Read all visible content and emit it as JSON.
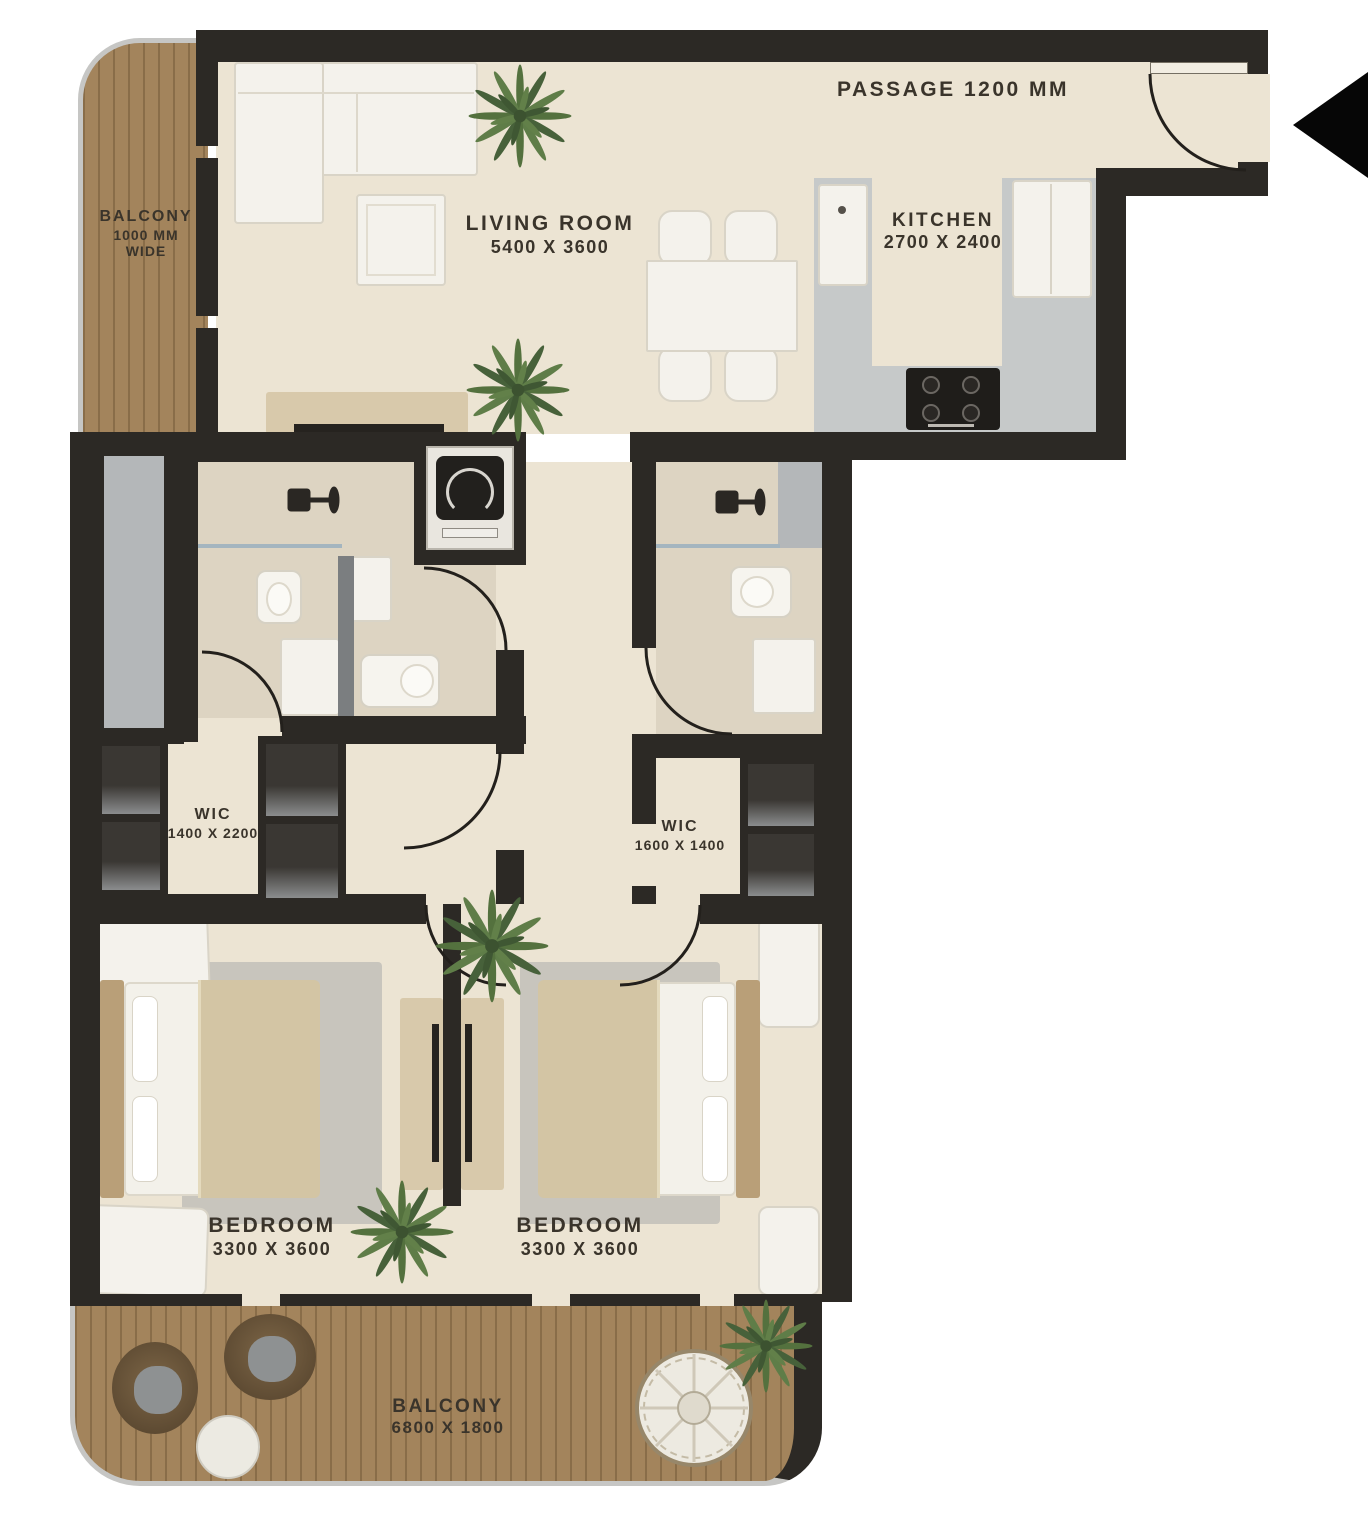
{
  "plan_title": "2 Bedroom Apartment Floor Plan",
  "rooms": {
    "balcony_top": {
      "name": "BALCONY",
      "dim_line1": "1000 MM",
      "dim_line2": "WIDE"
    },
    "living": {
      "name": "LIVING ROOM",
      "dims": "5400 X 3600"
    },
    "passage": {
      "name": "PASSAGE 1200 MM"
    },
    "kitchen": {
      "name": "KITCHEN",
      "dims": "2700 X 2400"
    },
    "wic_left": {
      "name": "WIC",
      "dims": "1400 X 2200"
    },
    "wic_right": {
      "name": "WIC",
      "dims": "1600 X 1400"
    },
    "bedroom_left": {
      "name": "BEDROOM",
      "dims": "3300 X 3600"
    },
    "bedroom_right": {
      "name": "BEDROOM",
      "dims": "3300 X 3600"
    },
    "balcony_bottom": {
      "name": "BALCONY",
      "dims": "6800 X 1800"
    }
  },
  "icons": {
    "entrance_arrow": "◀",
    "plant": "plant-foliage",
    "shower": "shower-head"
  },
  "colors": {
    "wall": "#2c2925",
    "floor": "#ece4d3",
    "bath_floor": "#ddd4c2",
    "wood_deck": "#a3845c",
    "counter_gray": "#c6c9c9",
    "panel_gray": "#b4b7b9",
    "furniture_white": "#f4f2ec",
    "wardrobe_tan": "#d8c9ab",
    "label_text": "#3a342b",
    "plant_green": "#54713e",
    "arrow_black": "#060606"
  }
}
